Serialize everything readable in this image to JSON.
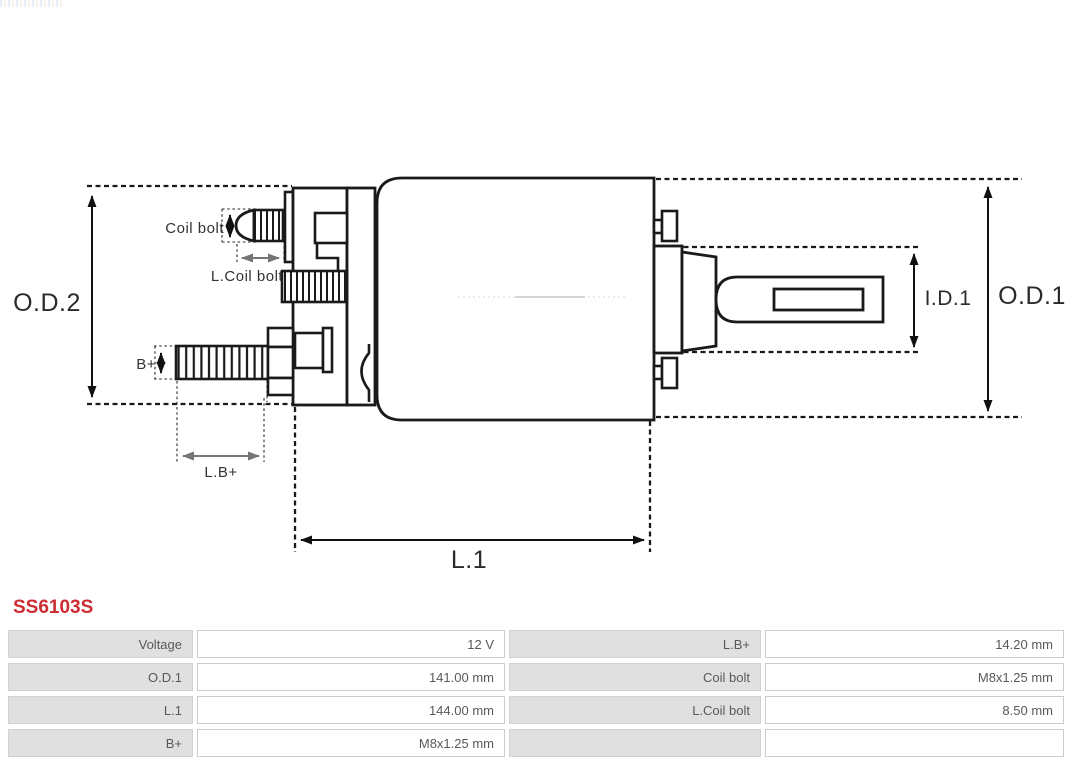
{
  "part": {
    "number": "SS6103S",
    "accent_color": "#cc2d33"
  },
  "diagram": {
    "labels": {
      "od2": "O.D.2",
      "od1": "O.D.1",
      "id1": "I.D.1",
      "l1": "L.1",
      "lb_plus": "L.B+",
      "b_plus": "B+",
      "coil_bolt": "Coil bolt",
      "l_coil_bolt": "L.Coil bolt"
    },
    "colors": {
      "line": "#1a1a1a",
      "dim_arrow_gray": "#757575"
    }
  },
  "spec_table": {
    "rows": [
      {
        "cells": [
          "Voltage",
          "12 V",
          "L.B+",
          "14.20 mm"
        ]
      },
      {
        "cells": [
          "O.D.1",
          "141.00 mm",
          "Coil bolt",
          "M8x1.25 mm"
        ]
      },
      {
        "cells": [
          "L.1",
          "144.00 mm",
          "L.Coil bolt",
          "8.50 mm"
        ]
      },
      {
        "cells": [
          "B+",
          "M8x1.25 mm",
          "",
          ""
        ]
      }
    ]
  }
}
